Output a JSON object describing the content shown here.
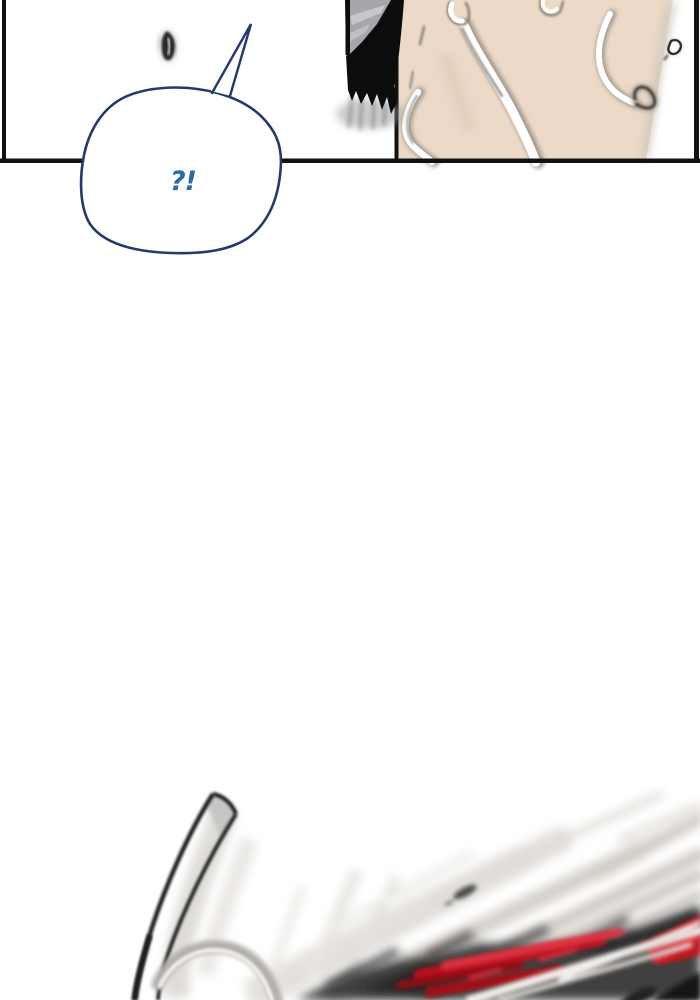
{
  "page": {
    "kind": "webtoon-comic-strip-segment",
    "background_color": "#ffffff"
  },
  "speech_bubble": {
    "text": "?!"
  },
  "colors": {
    "page_bg": "#ffffff",
    "panel_border": "#111111",
    "skin": "#ecd9c8",
    "hair": "#0d0d0d",
    "cloth_gray": "#a8a6ac",
    "cloth_stripe": "#c9c7cd",
    "bubble_outline": "#24396e",
    "bubble_text": "#2b6aa3",
    "blade_dark": "#1f1f1f",
    "action_dark": "#3f3f3f",
    "action_red": "#c4121c",
    "action_red_bright": "#e03040"
  }
}
